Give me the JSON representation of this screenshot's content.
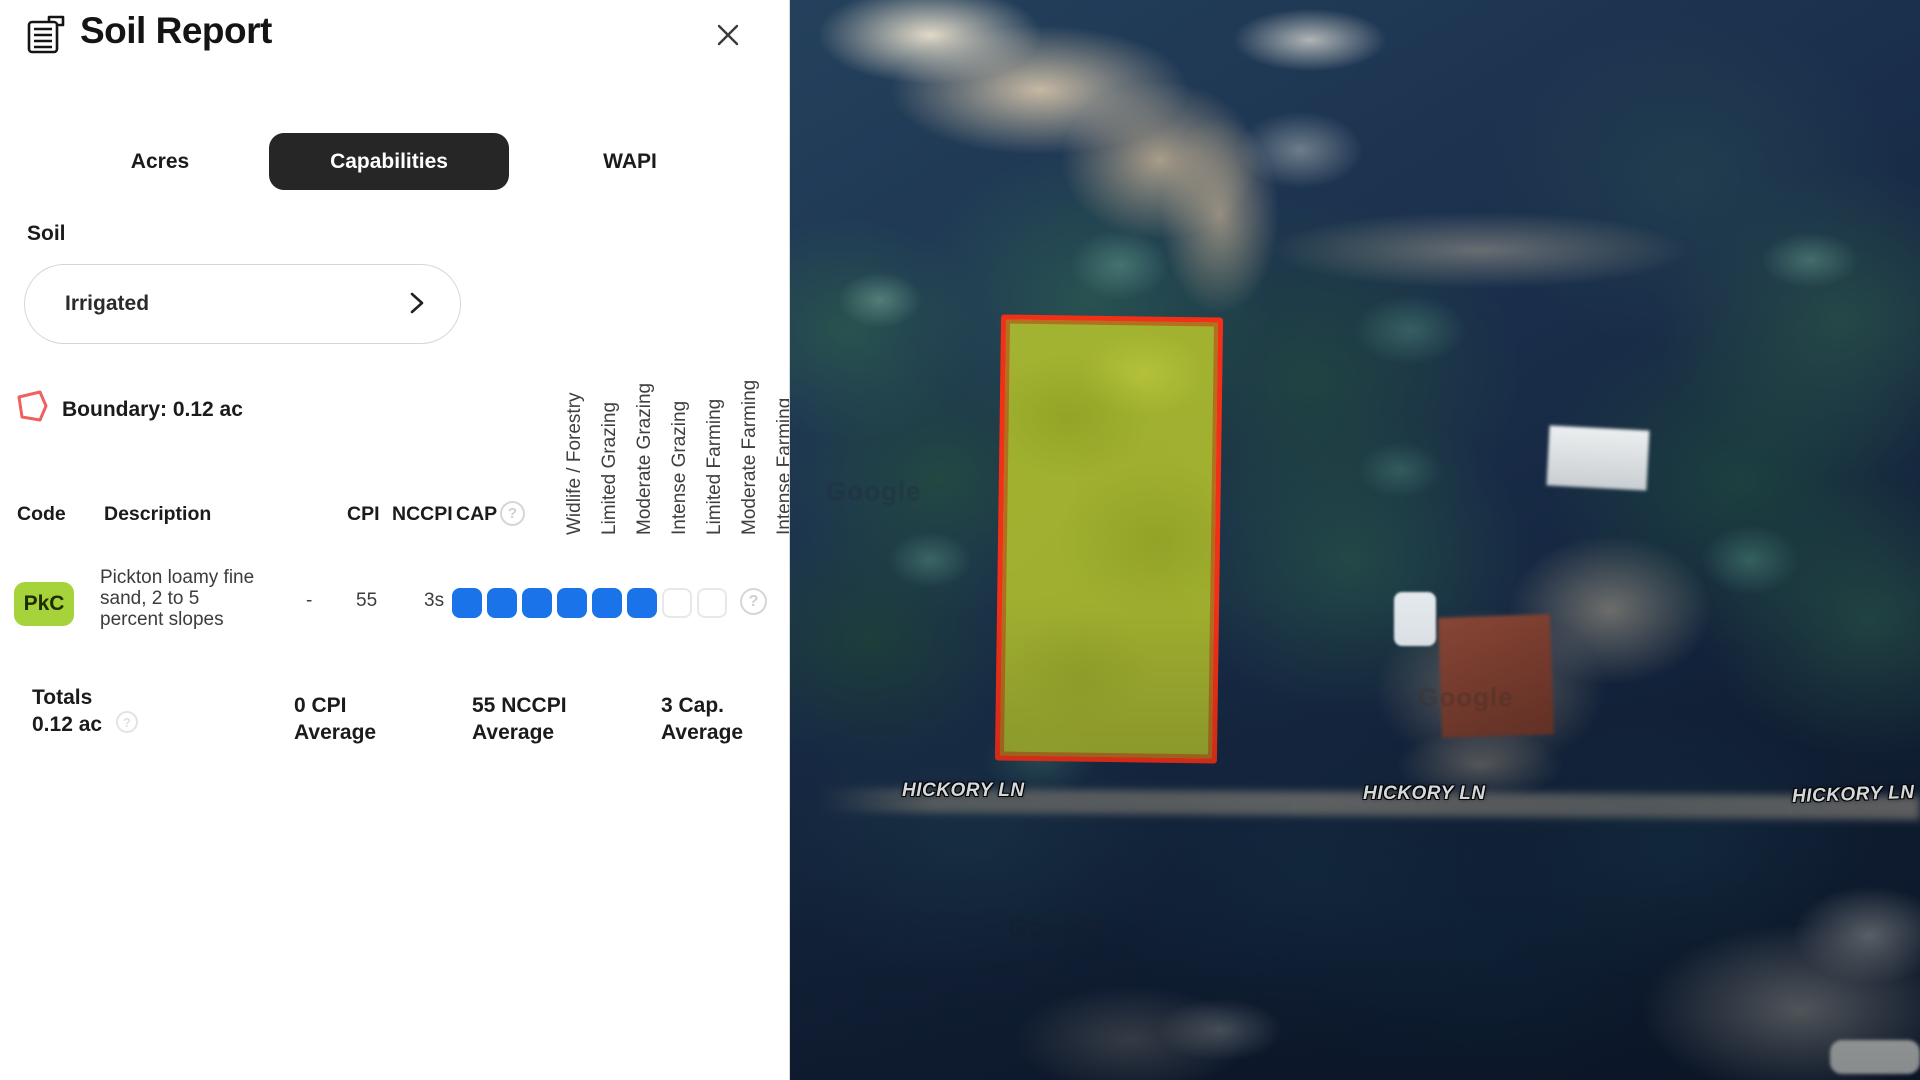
{
  "panel": {
    "title": "Soil Report",
    "tabs": [
      {
        "label": "Acres",
        "active": false
      },
      {
        "label": "Capabilities",
        "active": true
      },
      {
        "label": "WAPI",
        "active": false
      }
    ],
    "soil": {
      "label": "Soil",
      "selected": "Irrigated"
    },
    "boundary": {
      "label": "Boundary: 0.12 ac"
    },
    "table": {
      "headers": {
        "code": "Code",
        "description": "Description",
        "cpi": "CPI",
        "nccpi": "NCCPI",
        "cap": "CAP"
      },
      "capability_headers": [
        "Widlife / Forestry",
        "Limited Grazing",
        "Moderate Grazing",
        "Intense Grazing",
        "Limited Farming",
        "Moderate Farming",
        "Intense Farming"
      ],
      "row": {
        "code": "PkC",
        "description_lines": [
          "Pickton loamy fine",
          "sand, 2 to 5",
          "percent slopes"
        ],
        "cpi": "-",
        "nccpi": "55",
        "cap_class": "3s",
        "cap_filled": 6,
        "cap_total": 8
      }
    },
    "totals": {
      "label": "Totals",
      "acres": "0.12 ac",
      "cpi_line1": "0 CPI",
      "cpi_line2": "Average",
      "nccpi_line1": "55 NCCPI",
      "nccpi_line2": "Average",
      "cap_line1": "3 Cap.",
      "cap_line2": "Average"
    }
  },
  "map": {
    "street_label": "HICKORY LN",
    "watermark": "Google"
  },
  "icons": {
    "help": "?"
  },
  "colors": {
    "tab_active_bg": "#262626",
    "badge_green": "#a6d23a",
    "capability_blue": "#1a73e8",
    "boundary_red": "#f23018",
    "parcel_fill": "#b8c62c"
  }
}
